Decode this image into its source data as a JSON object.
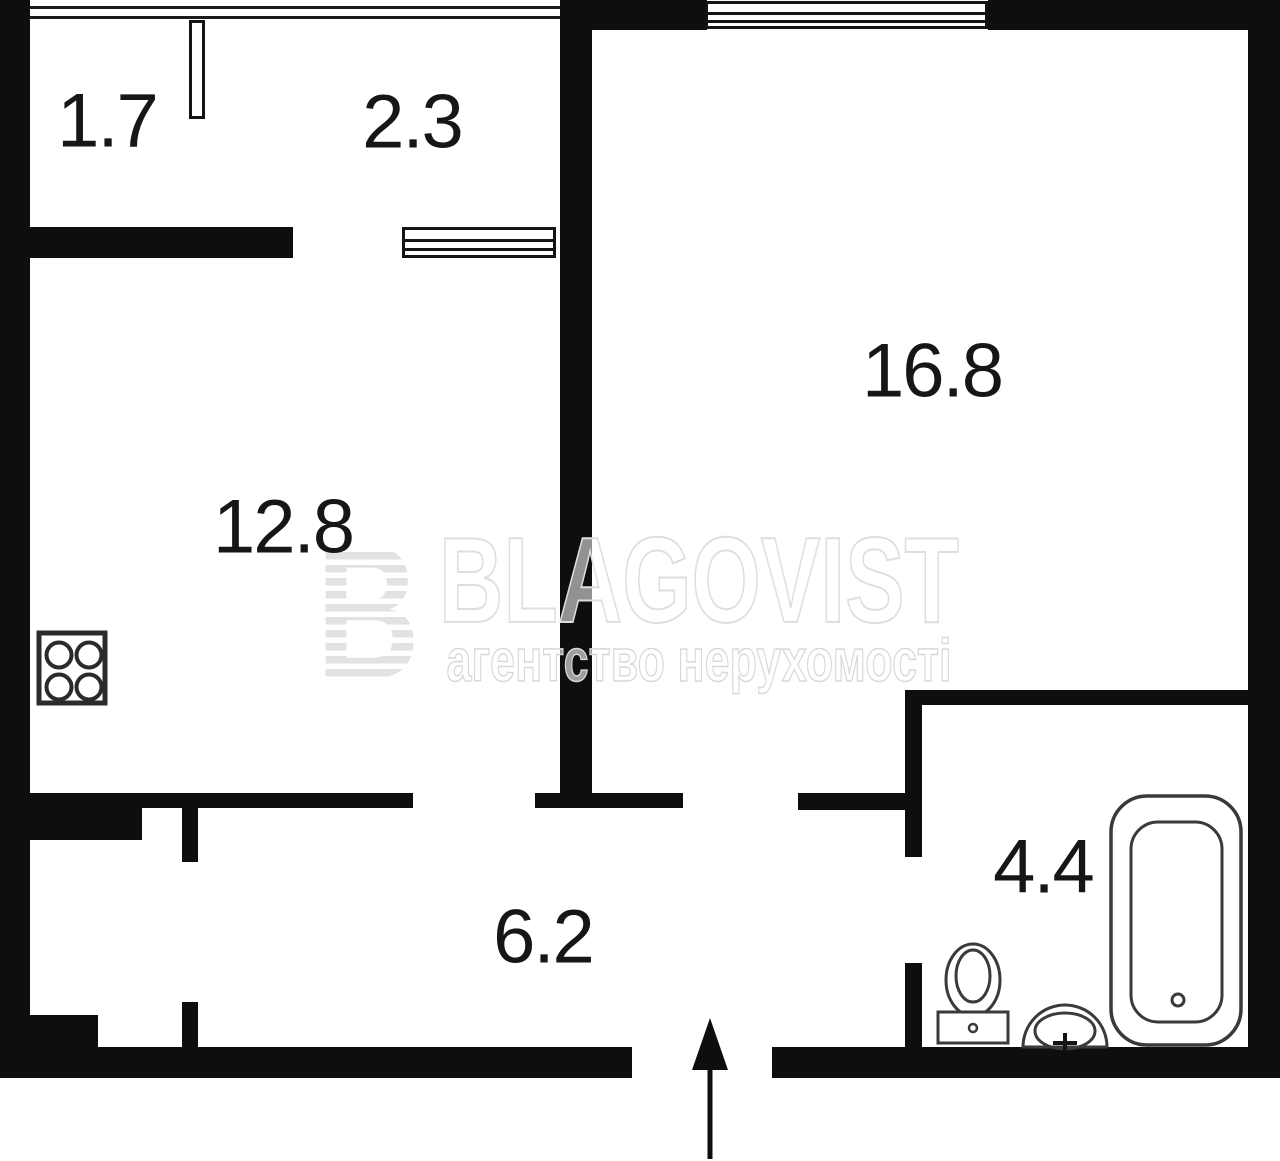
{
  "rooms": {
    "balcony_small": "1.7",
    "balcony_large": "2.3",
    "living_room": "16.8",
    "kitchen": "12.8",
    "hallway": "6.2",
    "bathroom": "4.4"
  },
  "watermark": {
    "logo_letter": "B",
    "brand": "BLAGOVIST",
    "tagline": "агентство нерухомості"
  },
  "icons": {
    "stove": "stove-icon",
    "bathtub": "bathtub-icon",
    "toilet": "toilet-icon",
    "sink": "sink-icon",
    "entry_arrow": "entry-arrow-icon"
  },
  "colors": {
    "wall": "#0e0e0e",
    "fixture_line": "#3a3a3a",
    "label_text": "#161616",
    "watermark_gray": "#e2e2e2",
    "background": "#ffffff"
  }
}
